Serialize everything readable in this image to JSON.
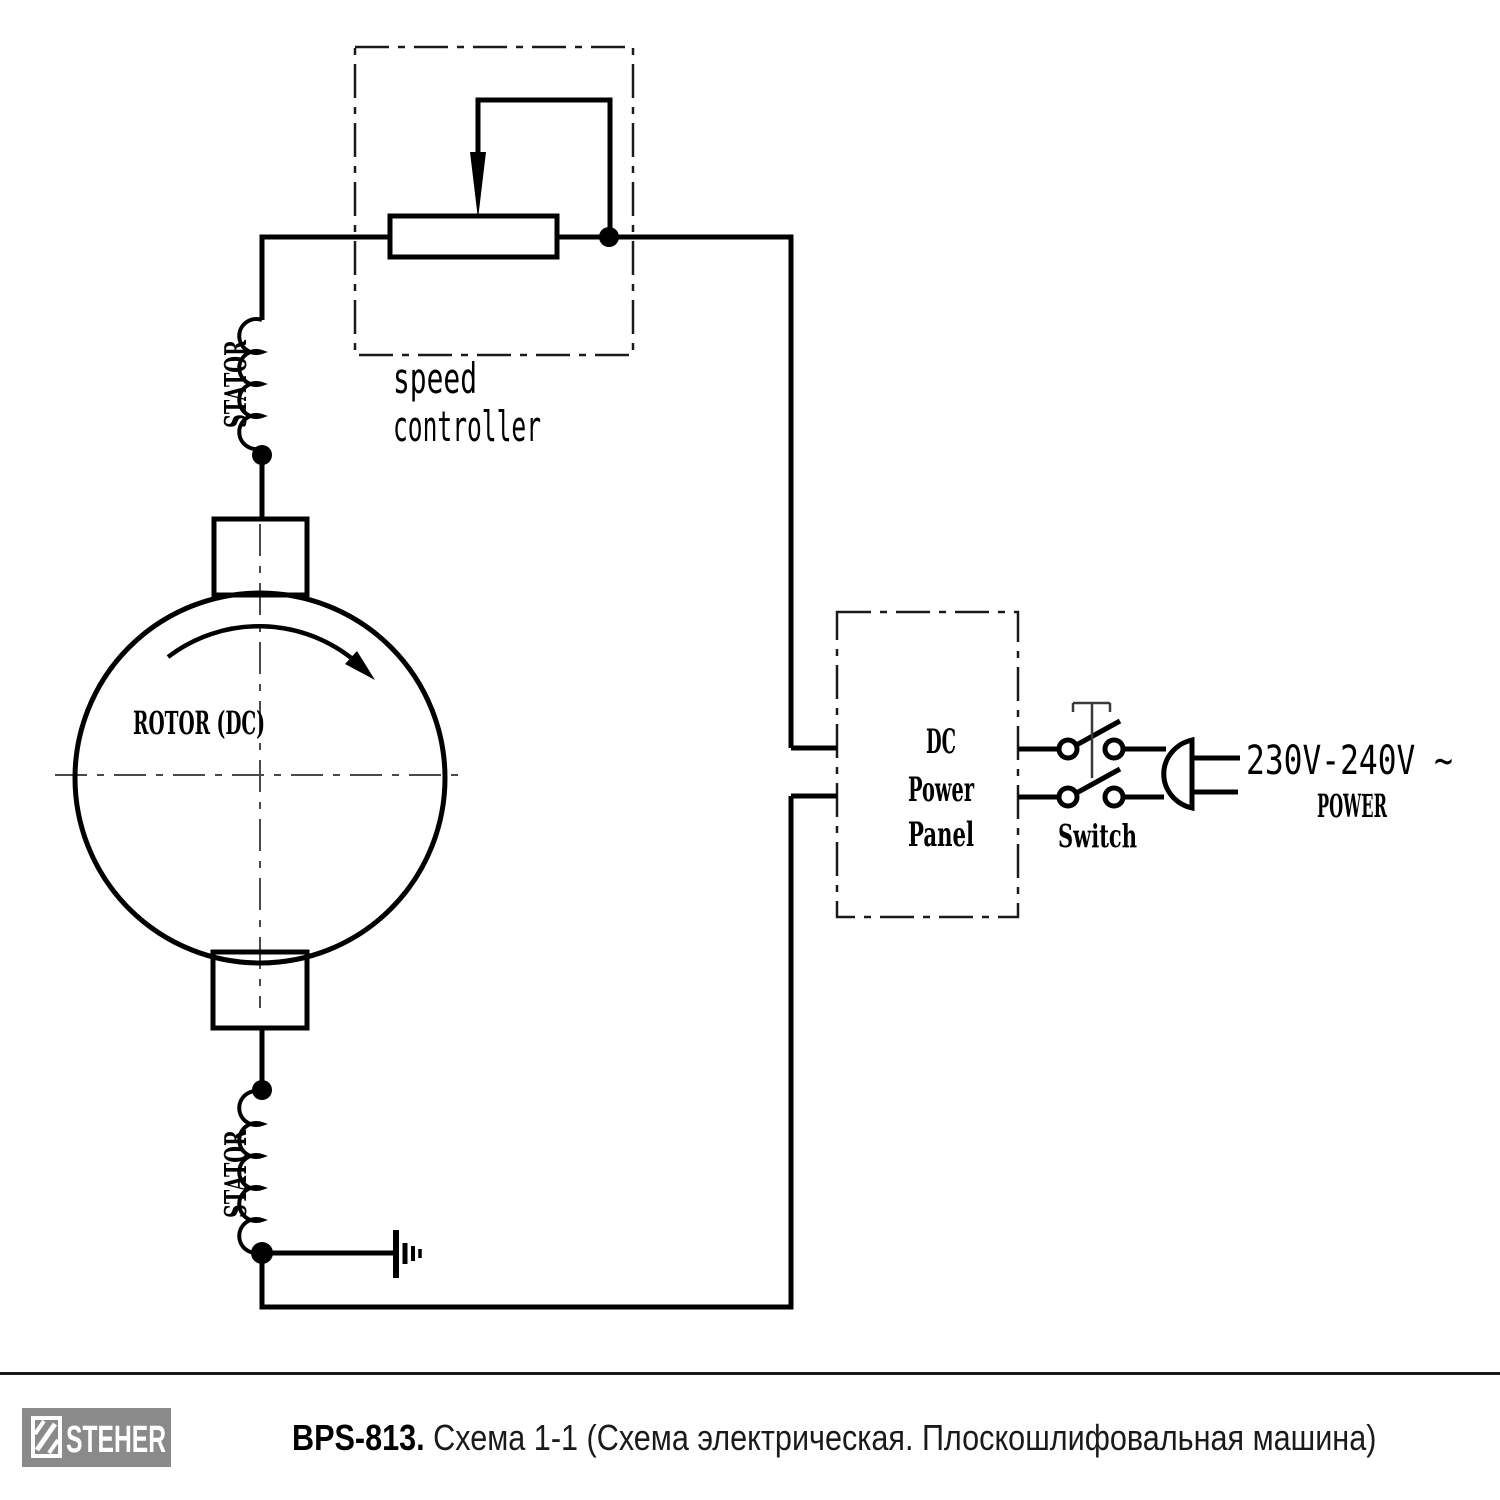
{
  "diagram": {
    "speed_controller": {
      "line1": "speed",
      "line2": "controller"
    },
    "rotor_label": "ROTOR (DC)",
    "stator_top_label": "STATOR",
    "stator_bottom_label": "STATOR",
    "power_panel": {
      "line1": "DC",
      "line2": "Power",
      "line3": "Panel"
    },
    "switch_label": "Switch",
    "voltage_label": "230V-240V ~",
    "power_label": "POWER"
  },
  "footer": {
    "brand": "STEHER",
    "model": "BPS-813.",
    "caption": "Схема 1-1 (Схема электрическая. Плоскошлифовальная машина)"
  },
  "colors": {
    "line": "#000000",
    "dashed_box": "#1a1a1a",
    "centerline": "#4a4a4a",
    "logo_background": "#8a8a8a",
    "separator": "#1a1a1a"
  }
}
